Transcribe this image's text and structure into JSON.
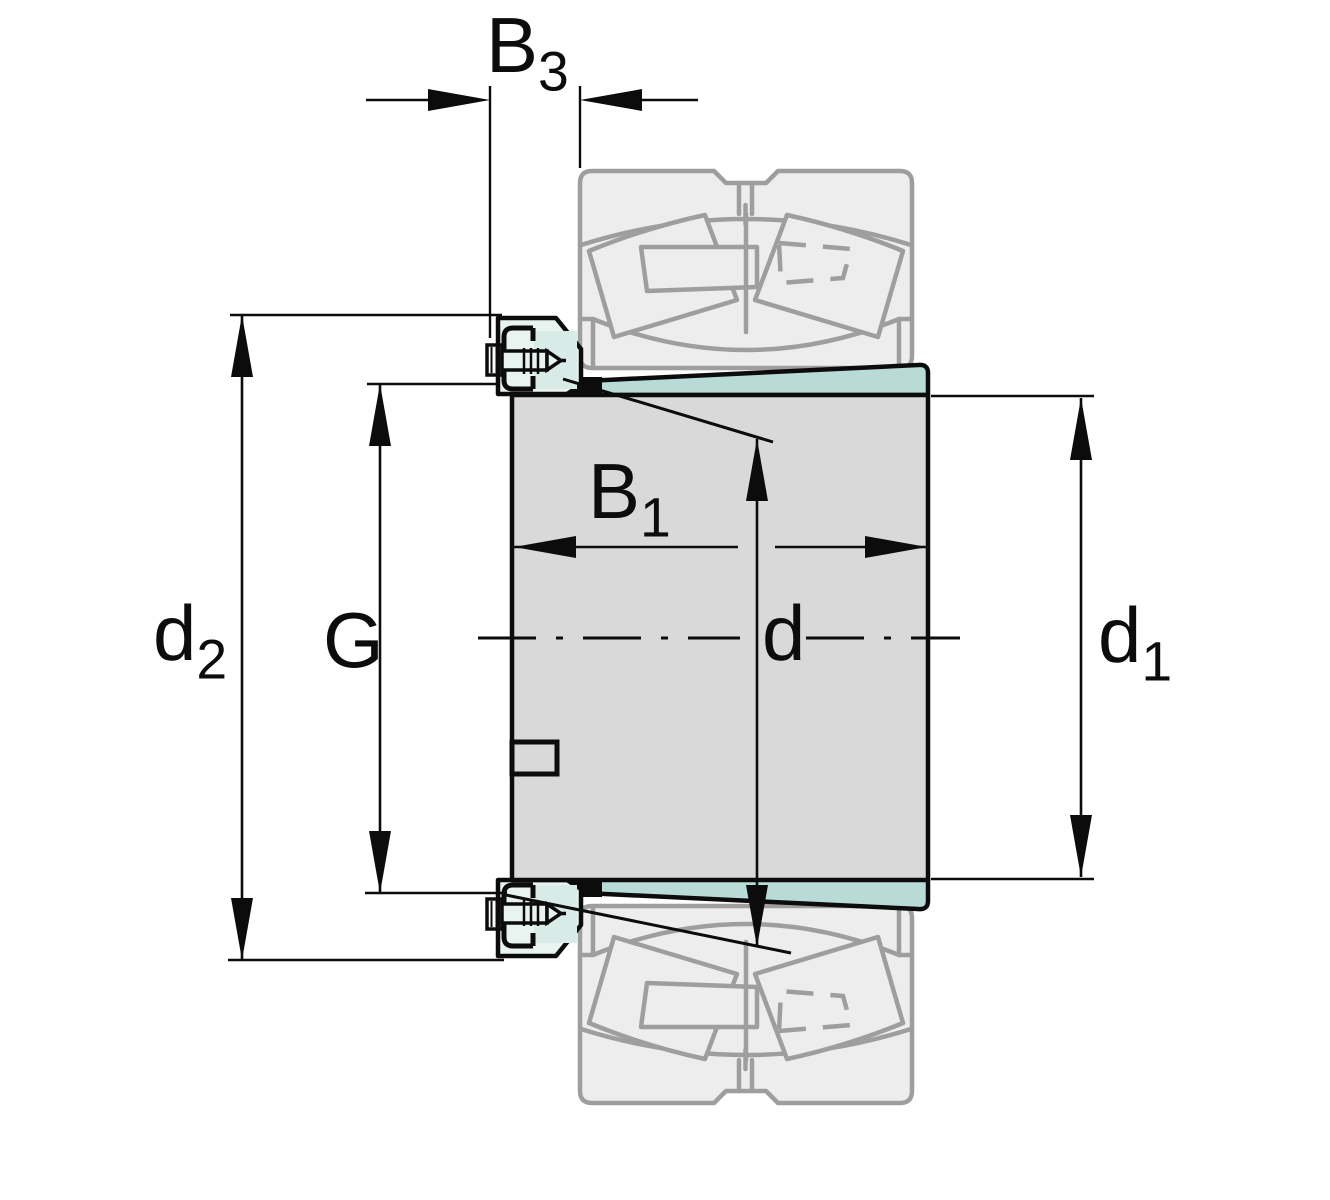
{
  "diagram": {
    "title": "Adapter sleeve with lock nut and spherical roller bearing — dimensioned section drawing",
    "labels": {
      "b3": {
        "base": "B",
        "sub": "3"
      },
      "b1": {
        "base": "B",
        "sub": "1"
      },
      "d2": {
        "base": "d",
        "sub": "2"
      },
      "g": {
        "base": "G",
        "sub": ""
      },
      "d": {
        "base": "d",
        "sub": ""
      },
      "d1": {
        "base": "d",
        "sub": "1"
      }
    },
    "colors": {
      "line-black": "#0c0c0c",
      "sleeve-gray": "#d9d9d9",
      "taper-teal": "#b9dbd8",
      "nut-fill": "#e9f3ef",
      "nut-inner": "#d8ebe6",
      "ghost-fill": "#ededed",
      "ghost-stroke": "#9e9e9e"
    }
  }
}
